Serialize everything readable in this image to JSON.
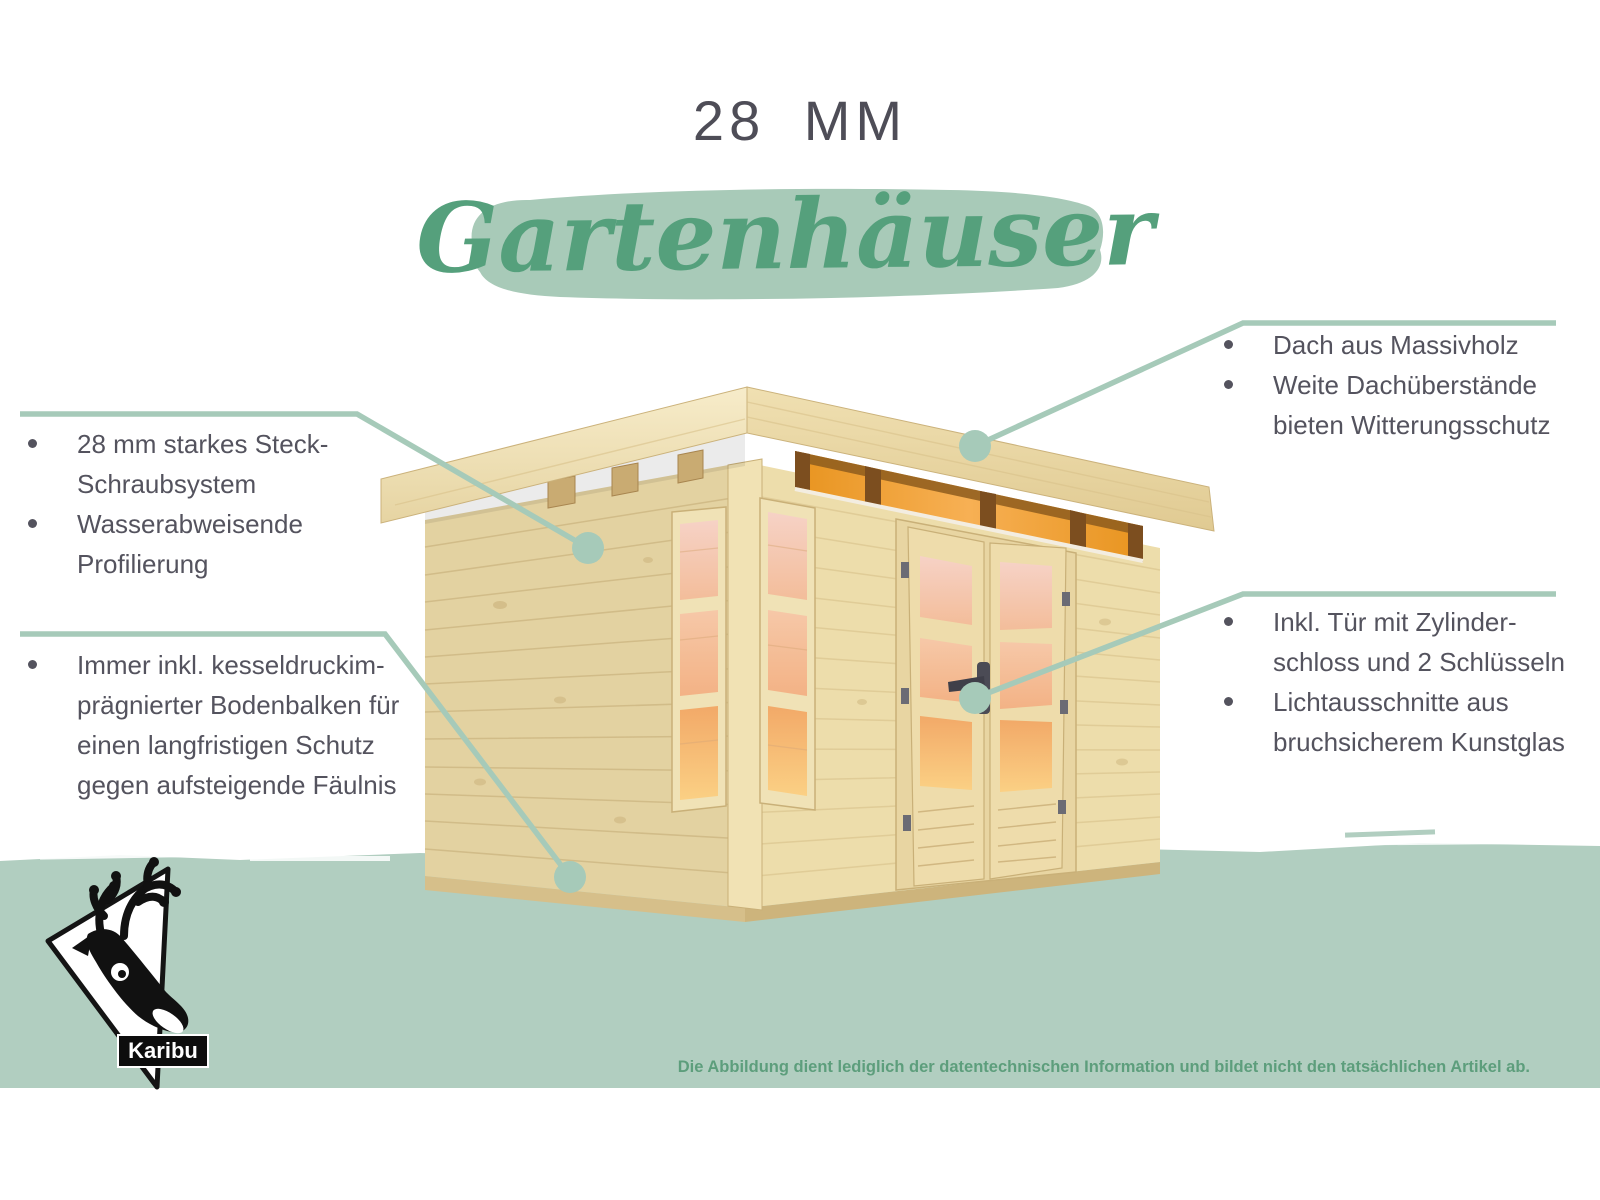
{
  "title": {
    "size_label": "28 MM",
    "category": "Gartenhäuser"
  },
  "callouts": {
    "top_left": {
      "items": [
        "28 mm starkes Steck-Schraubsystem",
        "Wasserabweisende Profilierung"
      ]
    },
    "bottom_left": {
      "items": [
        "Immer inkl. kesseldruckim-prägnierter Bodenbalken für einen langfristigen Schutz gegen aufsteigende Fäulnis"
      ]
    },
    "top_right": {
      "items": [
        "Dach aus Massivholz",
        "Weite Dachüberstände bieten Witterungsschutz"
      ]
    },
    "bottom_right": {
      "items": [
        "Inkl. Tür mit Zylinder-schloss und 2 Schlüsseln",
        "Lichtausschnitte aus bruchsicherem Kunstglas"
      ]
    }
  },
  "brand": {
    "name": "Karibu",
    "logo_icon": "caribou-head-icon"
  },
  "disclaimer": "Die Abbildung dient lediglich der datentechnischen Information und bildet nicht den tatsächlichen Artikel ab.",
  "colors": {
    "sage_brush": "#a8cab8",
    "sage_band": "#b1cec0",
    "callout_line": "#a6cab9",
    "script_green": "#55a07c",
    "disclaimer_green": "#5d9e7c",
    "text_dark": "#54535e",
    "title_dark": "#4e4d57",
    "wood_light": "#eddbaa",
    "window_glow": "#f5ad5f"
  }
}
